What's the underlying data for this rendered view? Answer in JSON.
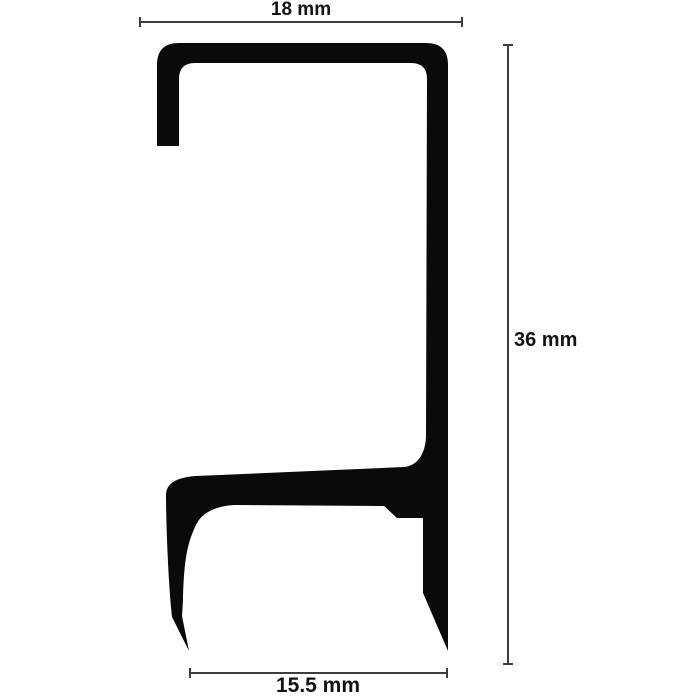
{
  "diagram": {
    "colors": {
      "background": "#ffffff",
      "profile": "#0a0a0a",
      "dimension_lines": "#3d3d3d",
      "text": "#141414"
    },
    "dimensions": {
      "top_width": {
        "label": "18 mm",
        "value": "18",
        "unit": "mm"
      },
      "right_height": {
        "label": "36 mm",
        "value": "36",
        "unit": "mm"
      },
      "bottom_width": {
        "label": "15.5 mm",
        "value": "15.5",
        "unit": "mm"
      }
    }
  }
}
